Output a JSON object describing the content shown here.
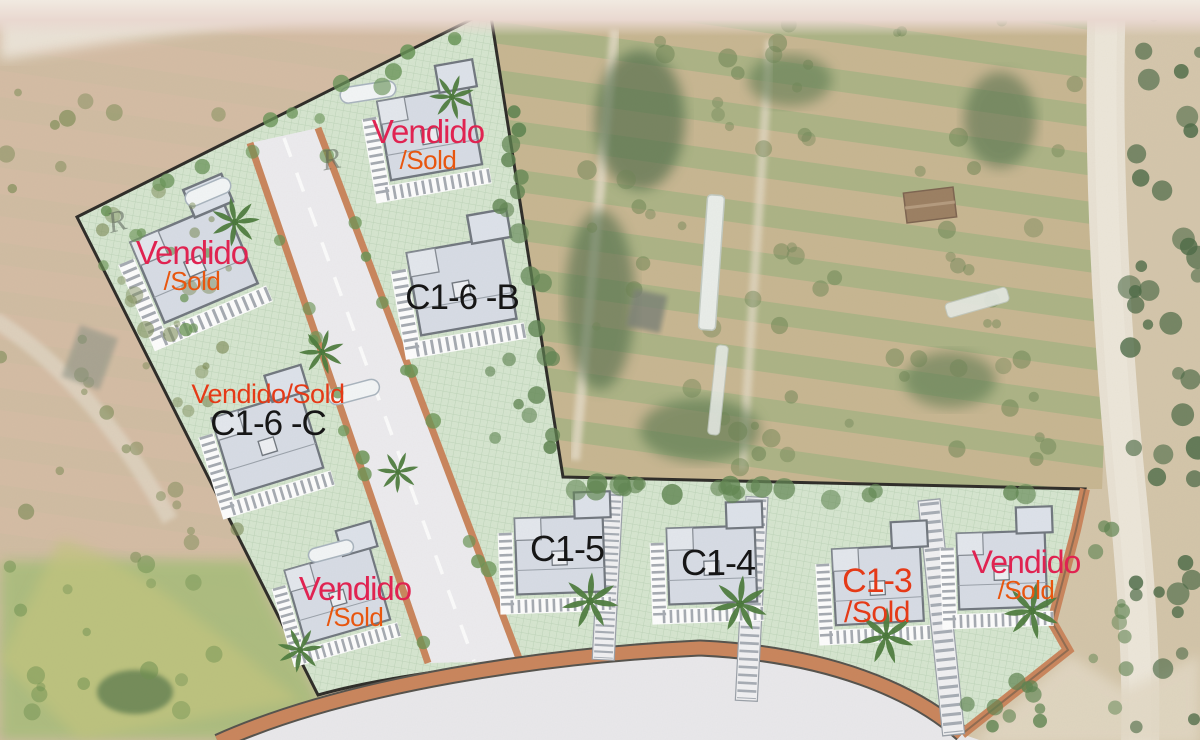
{
  "plan": {
    "plots": [
      {
        "id": "plot-northwest",
        "lines": [
          {
            "text": "Vendido",
            "color": "crimson"
          },
          {
            "text": "/Sold",
            "color": "orange"
          }
        ]
      },
      {
        "id": "plot-north",
        "lines": [
          {
            "text": "Vendido",
            "color": "crimson"
          },
          {
            "text": "/Sold",
            "color": "orange"
          }
        ]
      },
      {
        "id": "plot-c1-6-b",
        "lines": [
          {
            "text": "C1-6 -B",
            "color": "black"
          }
        ]
      },
      {
        "id": "plot-c1-6-c",
        "lines": [
          {
            "text": "Vendido/Sold",
            "color": "red"
          },
          {
            "text": "C1-6 -C",
            "color": "black"
          }
        ]
      },
      {
        "id": "plot-southwest",
        "lines": [
          {
            "text": "Vendido",
            "color": "crimson"
          },
          {
            "text": "/Sold",
            "color": "orange"
          }
        ]
      },
      {
        "id": "plot-c1-5",
        "lines": [
          {
            "text": "C1-5",
            "color": "black"
          }
        ]
      },
      {
        "id": "plot-c1-4",
        "lines": [
          {
            "text": "C1-4",
            "color": "black"
          }
        ]
      },
      {
        "id": "plot-c1-3",
        "lines": [
          {
            "text": "C1-3",
            "color": "red"
          },
          {
            "text": "/Sold",
            "color": "red"
          }
        ]
      },
      {
        "id": "plot-southeast",
        "lines": [
          {
            "text": "Vendido",
            "color": "crimson"
          },
          {
            "text": "/Sold",
            "color": "orange"
          }
        ]
      }
    ],
    "handwritten_marks": [
      {
        "text": "R"
      },
      {
        "text": "R"
      }
    ],
    "colors": {
      "sold_crimson": "#e02351",
      "sold_orange": "#e8560f",
      "sold_red": "#e53a17",
      "label_black": "#161616",
      "plan_green": "#d5e5cf",
      "road_edge_terracotta": "#c9855c",
      "house_fill": "#d7dce5",
      "road_surface": "#e9e8eb"
    }
  }
}
